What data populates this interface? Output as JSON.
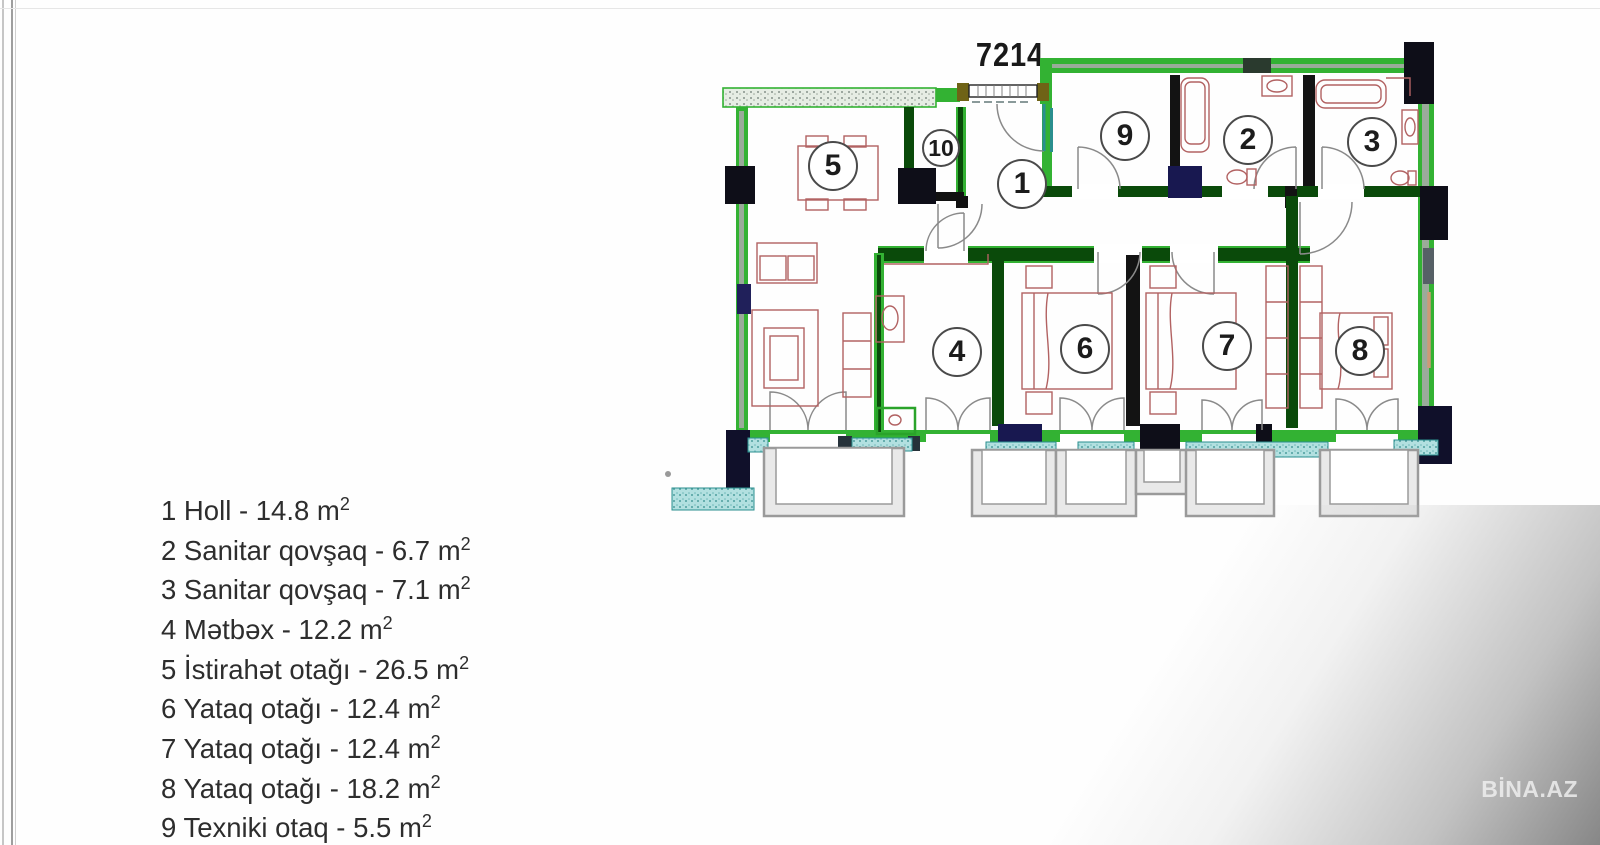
{
  "header": {
    "partial_top_text": "Eyvan sahəsi 3.5 m",
    "partial_top_sup": "2"
  },
  "plan": {
    "dimension_label": "7214"
  },
  "rooms": [
    {
      "number": "1",
      "name": "Holl",
      "area_m2": "14.8"
    },
    {
      "number": "2",
      "name": "Sanitar qovşaq",
      "area_m2": "6.7"
    },
    {
      "number": "3",
      "name": "Sanitar qovşaq",
      "area_m2": "7.1"
    },
    {
      "number": "4",
      "name": "Mətbəx",
      "area_m2": "12.2"
    },
    {
      "number": "5",
      "name": "İstirahət otağı",
      "area_m2": "26.5"
    },
    {
      "number": "6",
      "name": "Yataq otağı",
      "area_m2": "12.4"
    },
    {
      "number": "7",
      "name": "Yataq otağı",
      "area_m2": "12.4"
    },
    {
      "number": "8",
      "name": "Yataq otağı",
      "area_m2": "18.2"
    },
    {
      "number": "9",
      "name": "Texniki otaq",
      "area_m2": "5.5"
    },
    {
      "number": "10",
      "name": "Qarderob",
      "area_m2": "1.5"
    }
  ],
  "legend": {
    "items": [
      {
        "text": "1 Holl - 14.8 m",
        "sup": "2"
      },
      {
        "text": "2 Sanitar qovşaq - 6.7 m",
        "sup": "2"
      },
      {
        "text": "3 Sanitar qovşaq - 7.1 m",
        "sup": "2"
      },
      {
        "text": "4 Mətbəx - 12.2 m",
        "sup": "2"
      },
      {
        "text": "5 İstirahət otağı - 26.5 m",
        "sup": "2"
      },
      {
        "text": "6 Yataq otağı - 12.4 m",
        "sup": "2"
      },
      {
        "text": "7 Yataq otağı - 12.4 m",
        "sup": "2"
      },
      {
        "text": "8 Yataq otağı - 18.2 m",
        "sup": "2"
      },
      {
        "text": "9 Texniki otaq - 5.5 m",
        "sup": "2"
      },
      {
        "text": "10 Qarderob - 1.5 m",
        "sup": "2"
      }
    ]
  },
  "watermark": {
    "text": "BİNA.AZ"
  },
  "colors": {
    "wall_green": "#33b233",
    "wall_dark_green": "#0a4a0a",
    "wall_black": "#10101c",
    "furniture_red": "#b26262",
    "sill_teal": "#2a8f8f",
    "balcony_gray": "#9a9a9a"
  }
}
